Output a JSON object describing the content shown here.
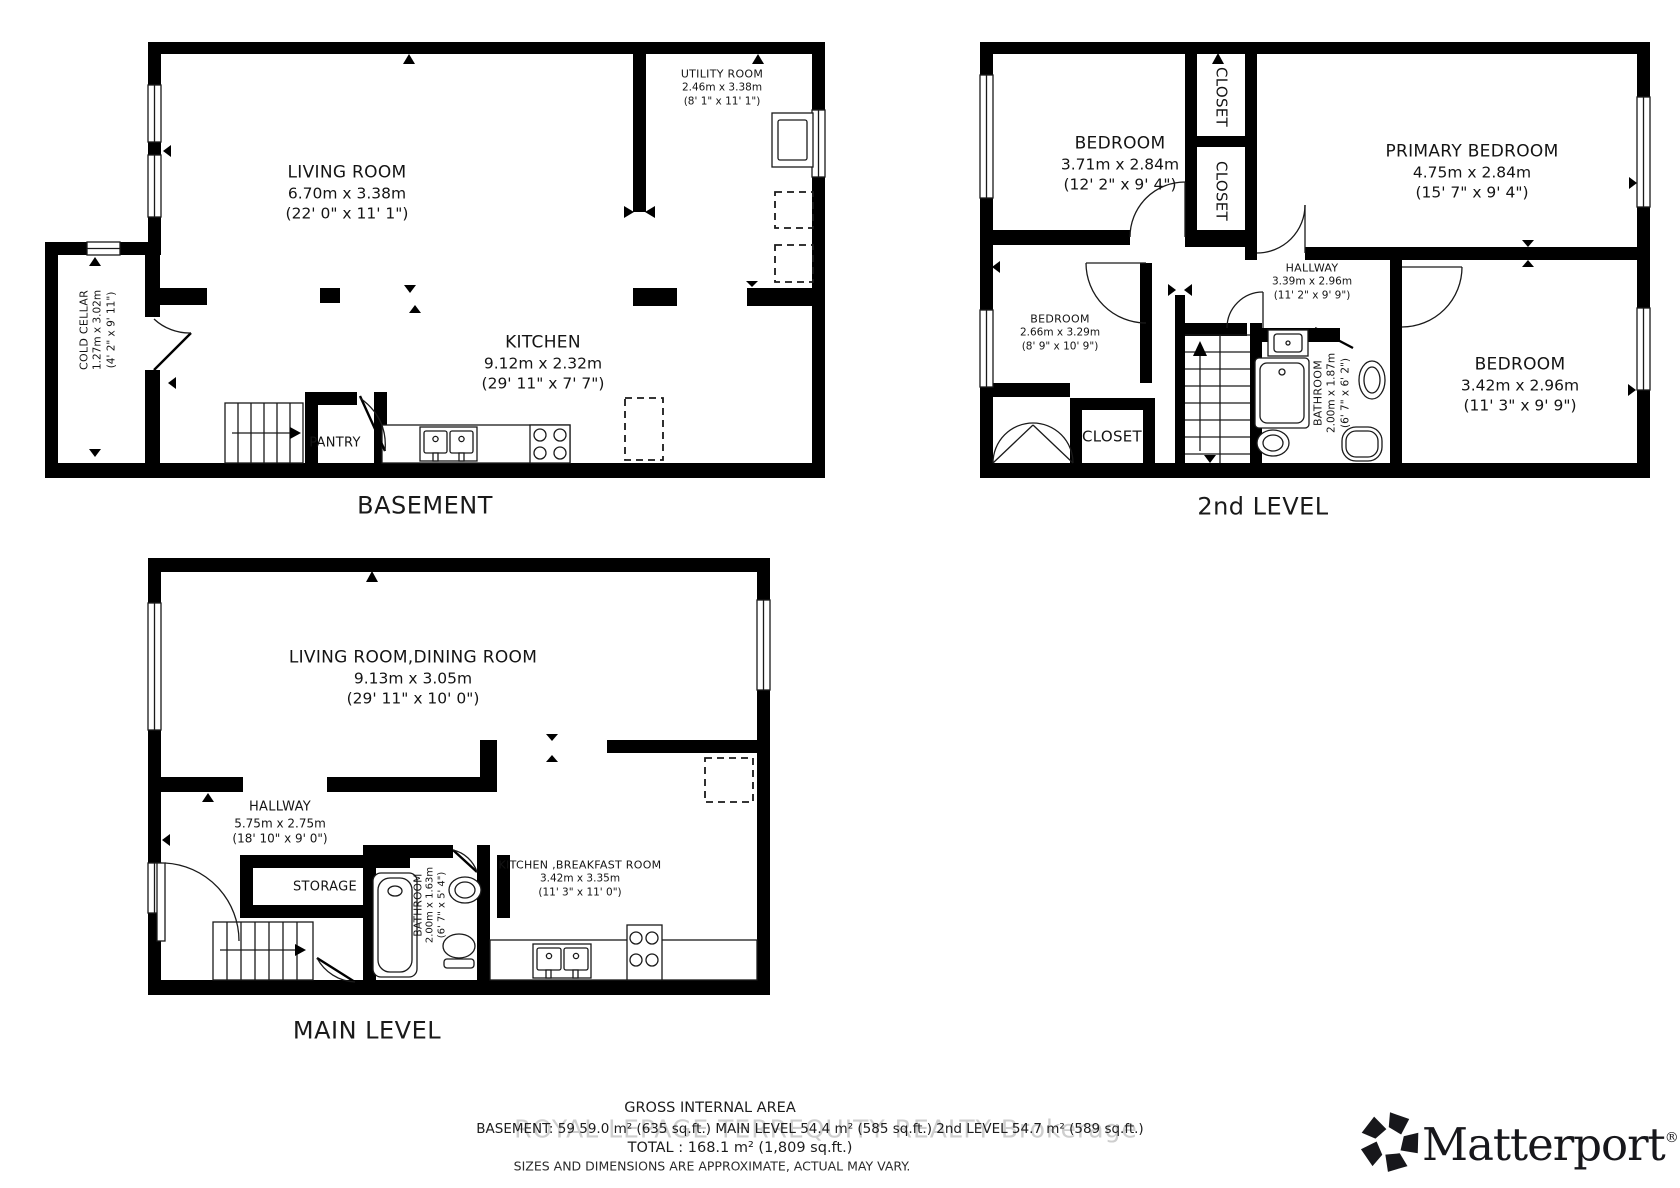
{
  "page": {
    "background": "#ffffff"
  },
  "floors": {
    "basement": {
      "label": "BASEMENT",
      "rooms": {
        "living_room": {
          "name": "LIVING ROOM",
          "metric": "6.70m x 3.38m",
          "imperial": "(22' 0\" x 11' 1\")"
        },
        "utility_room": {
          "name": "UTILITY ROOM",
          "metric": "2.46m x 3.38m",
          "imperial": "(8' 1\" x 11' 1\")"
        },
        "kitchen": {
          "name": "KITCHEN",
          "metric": "9.12m x 2.32m",
          "imperial": "(29' 11\" x 7' 7\")"
        },
        "cold_cellar": {
          "name": "COLD CELLAR",
          "metric": "1.27m x 3.02m",
          "imperial": "(4' 2\" x 9' 11\")"
        },
        "pantry": {
          "name": "PANTRY"
        }
      }
    },
    "main_level": {
      "label": "MAIN LEVEL",
      "rooms": {
        "living_dining": {
          "name": "LIVING ROOM,DINING ROOM",
          "metric": "9.13m x 3.05m",
          "imperial": "(29' 11\" x 10' 0\")"
        },
        "hallway": {
          "name": "HALLWAY",
          "metric": "5.75m x 2.75m",
          "imperial": "(18' 10\" x 9' 0\")"
        },
        "storage": {
          "name": "STORAGE"
        },
        "bathroom": {
          "name": "BATHROOM",
          "metric": "2.00m x 1.63m",
          "imperial": "(6' 7\" x 5' 4\")"
        },
        "kitchen_breakfast": {
          "name": "KITCHEN ,BREAKFAST ROOM",
          "metric": "3.42m x 3.35m",
          "imperial": "(11' 3\" x 11' 0\")"
        }
      }
    },
    "second_level": {
      "label": "2nd LEVEL",
      "rooms": {
        "bedroom_top_left": {
          "name": "BEDROOM",
          "metric": "3.71m x 2.84m",
          "imperial": "(12' 2\" x 9' 4\")"
        },
        "primary_bedroom": {
          "name": "PRIMARY BEDROOM",
          "metric": "4.75m x 2.84m",
          "imperial": "(15' 7\" x 9' 4\")"
        },
        "bedroom_mid_left": {
          "name": "BEDROOM",
          "metric": "2.66m x 3.29m",
          "imperial": "(8' 9\" x 10' 9\")"
        },
        "bedroom_right": {
          "name": "BEDROOM",
          "metric": "3.42m x 2.96m",
          "imperial": "(11' 3\" x 9' 9\")"
        },
        "hallway": {
          "name": "HALLWAY",
          "metric": "3.39m x 2.96m",
          "imperial": "(11' 2\" x 9' 9\")"
        },
        "bathroom": {
          "name": "BATHROOM",
          "metric": "2.00m x 1.87m",
          "imperial": "(6' 7\" x 6' 2\")"
        },
        "closet_upper": {
          "name": "CLOSET"
        },
        "closet_lower": {
          "name": "CLOSET"
        },
        "closet_bottom": {
          "name": "CLOSET"
        }
      }
    }
  },
  "footer": {
    "title": "GROSS INTERNAL AREA",
    "areas": "BASEMENT: 59 59.0 m² (635 sq.ft.) MAIN LEVEL 54.4 m² (585 sq.ft.)  2nd LEVEL 54.7 m² (589 sq.ft.)",
    "total": "TOTAL :  168.1 m² (1,809 sq.ft.)",
    "disclaimer": "SIZES AND DIMENSIONS ARE APPROXIMATE, ACTUAL MAY VARY.",
    "watermark": "ROYAL LEPAGE TERREQUITY REALTY Brokerage"
  },
  "branding": {
    "name": "Matterport",
    "registered": "®"
  },
  "colors": {
    "wall": "#000000",
    "line": "#1a1a1a",
    "text": "#141414",
    "watermark": "#c6c6c6",
    "background": "#ffffff"
  }
}
